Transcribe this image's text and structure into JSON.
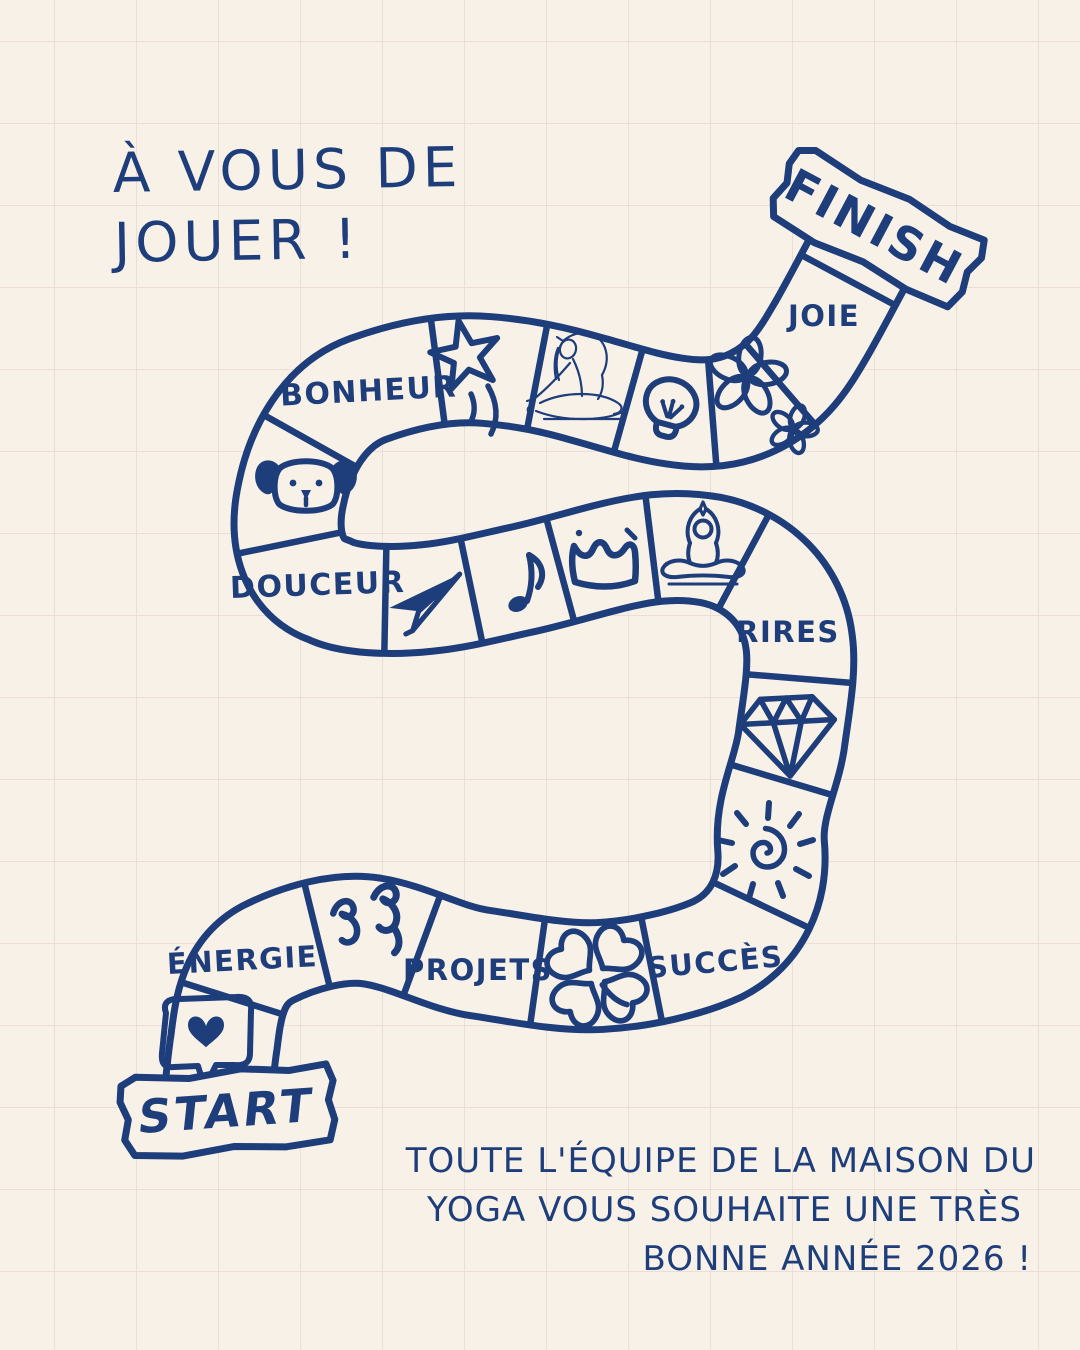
{
  "title": {
    "line1": "À VOUS DE",
    "line2": "JOUER !"
  },
  "banners": {
    "start": "START",
    "finish": "FINISH"
  },
  "labels": {
    "bonheur": "BONHEUR",
    "joie": "JOIE",
    "douceur": "DOUCEUR",
    "rires": "RIRES",
    "energie": "ÉNERGIE",
    "projets": "PROJETS",
    "succes": "SUCCÈS"
  },
  "footer": {
    "line1": "TOUTE L'ÉQUIPE DE LA MAISON DU",
    "line2": "YOGA VOUS SOUHAITE UNE TRÈS",
    "line3": "BONNE ANNÉE 2026 !"
  },
  "icons": [
    "heart-in-speech-bubble-icon",
    "energy-squiggle-icon",
    "four-leaf-clover-icon",
    "spiral-sun-icon",
    "diamond-icon",
    "meditation-pose-icon",
    "crown-icon",
    "music-note-icon",
    "paper-plane-icon",
    "dog-face-icon",
    "shooting-star-icon",
    "yoga-stretch-sketch-icon",
    "lightbulb-icon",
    "daisy-flowers-icon"
  ],
  "path_cells_in_order": [
    "START",
    "heart-in-speech-bubble",
    "ÉNERGIE",
    "energy-squiggle",
    "PROJETS",
    "four-leaf-clover",
    "SUCCÈS",
    "spiral-sun",
    "diamond",
    "RIRES",
    "meditation-pose",
    "crown",
    "music-note",
    "paper-plane",
    "DOUCEUR",
    "dog-face",
    "BONHEUR",
    "shooting-star",
    "yoga-stretch-sketch",
    "lightbulb",
    "daisy-flowers",
    "JOIE",
    "FINISH"
  ],
  "colors": {
    "ink": "#1e3d7b",
    "background": "#f8f1e8",
    "grid": "#ecddd6"
  }
}
